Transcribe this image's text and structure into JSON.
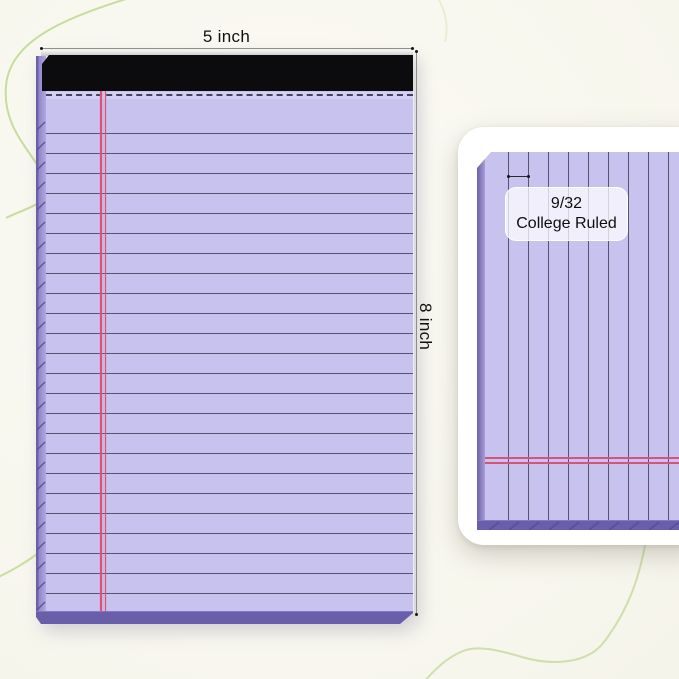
{
  "product_view": {
    "name": "legal-notepad-front-view",
    "width_dimension": "5 inch",
    "height_dimension": "8 inch"
  },
  "detail_card": {
    "ruling_size": "9/32",
    "ruling_type": "College Ruled"
  },
  "colors": {
    "paper": "#c8c2ee",
    "ruled_line": "#565273",
    "margin_line": "#d8527a",
    "binding_strip": "#0c0c0e",
    "pad_edge": "#695ea9",
    "spine": "#9187ca",
    "background": "#f7f6ed",
    "decorative_curve": "#bdd88f",
    "dimension_line": "#8e8e8e"
  },
  "icons": {
    "width_arrow": "horizontal-dimension-arrow",
    "height_arrow": "vertical-dimension-arrow",
    "spacing_arrow": "line-spacing-arrow"
  }
}
